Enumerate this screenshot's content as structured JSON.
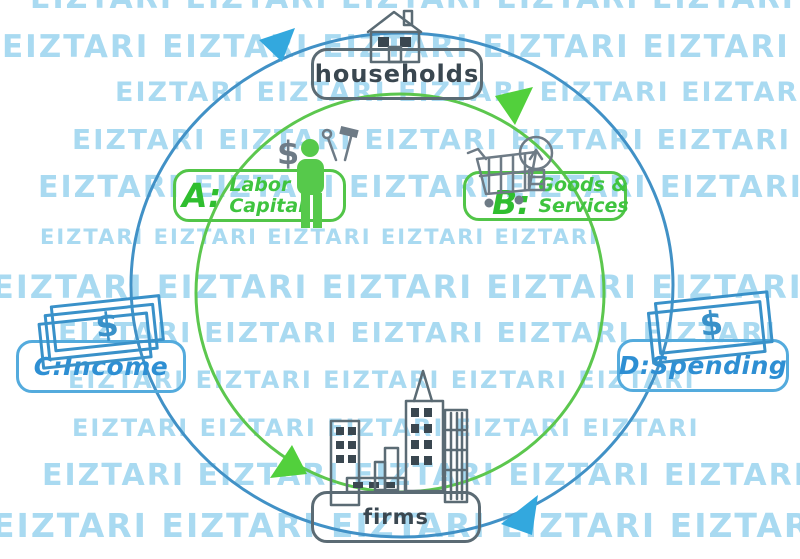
{
  "watermark": {
    "text": "EIZTARI"
  },
  "nodes": {
    "households": "households",
    "firms": "firms"
  },
  "flows": {
    "a": {
      "key": "A:",
      "line1": "Labor &",
      "line2": "Capital"
    },
    "b": {
      "key": "B:",
      "line1": "Goods &",
      "line2": "Services"
    },
    "c": {
      "text": "C:Income"
    },
    "d": {
      "text": "D:Spending"
    }
  },
  "icons": {
    "dollar_sign": "$"
  },
  "colors": {
    "watermark": "#a9daf1",
    "circle_blue": "#4191c6",
    "circle_green": "#5cc74e",
    "arrow_blue": "#33a8de",
    "arrow_green": "#52d03c",
    "green": "#52c548",
    "green_text": "#2fbe2f",
    "green_label": "#3fc43f",
    "blue": "#54abdd",
    "blue_text": "#2e8fd3",
    "bill_blue": "#3991c9",
    "outline_gray": "#5b6b74",
    "dark_text": "#3a4750",
    "icon_gray": "#6e7b86",
    "person_green": "#56c94b"
  }
}
